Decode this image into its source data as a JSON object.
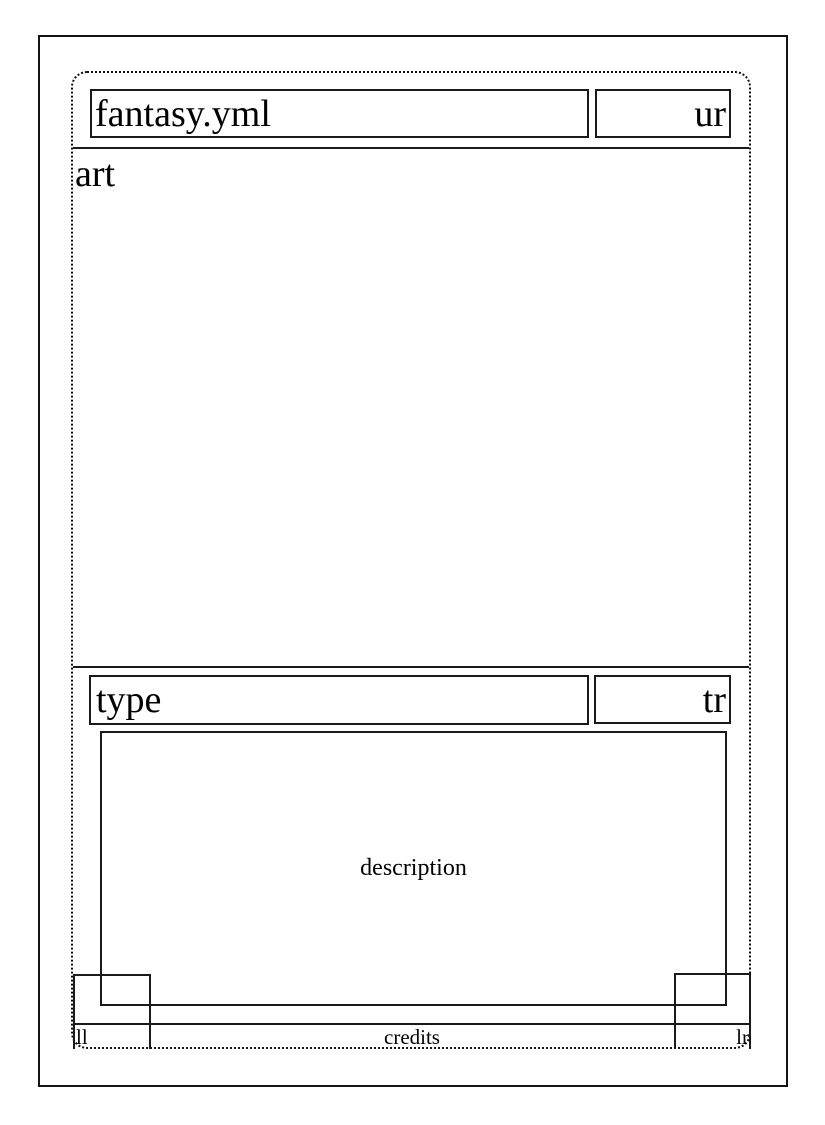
{
  "page": {
    "background_color": "#ffffff",
    "line_color": "#1a1a1a",
    "text_color": "#000000"
  },
  "card_template": {
    "title_bar": {
      "name": "fantasy.yml",
      "upper_right": "ur"
    },
    "art_region": {
      "label": "art"
    },
    "type_bar": {
      "type": "type",
      "type_right": "tr"
    },
    "description_region": {
      "label": "description"
    },
    "credits_bar": {
      "lower_left": "ll",
      "credits": "credits",
      "lower_right": "lr"
    }
  }
}
